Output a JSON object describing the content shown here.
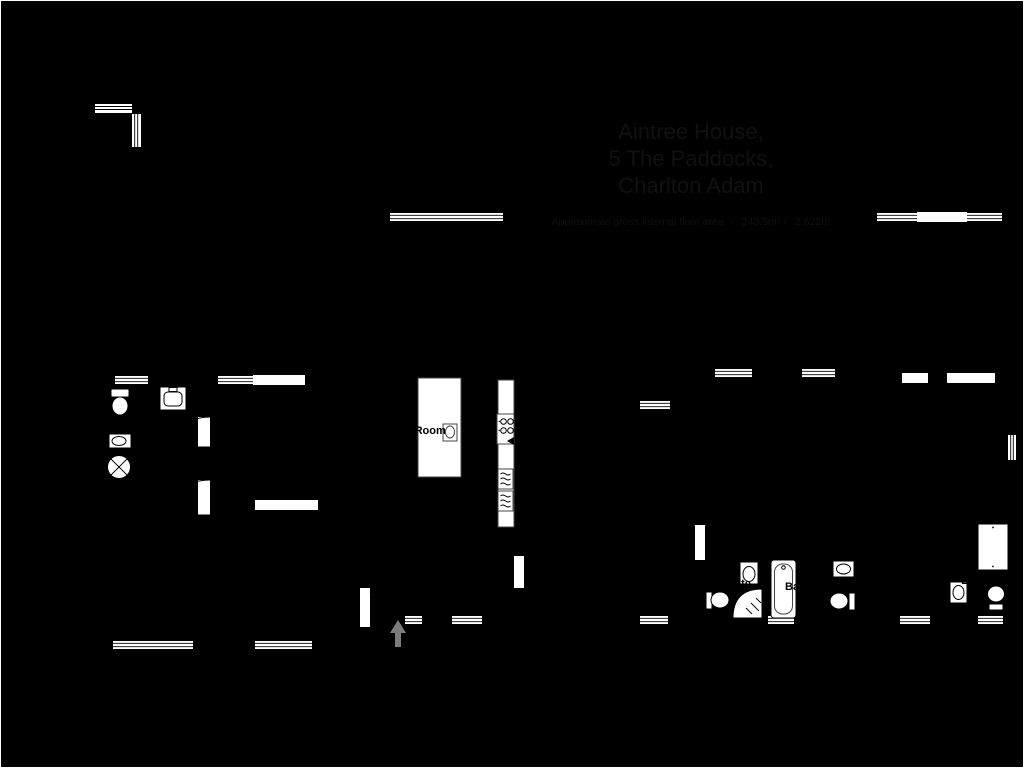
{
  "page": {
    "title_lines": [
      "Aintree House,",
      "5 The Paddocks,",
      "Charlton Adam"
    ],
    "subtitle": "Approximate gross internal floor area  -   243.5m² /   2,622ft²"
  },
  "compass": {
    "north": "N",
    "east": "E",
    "south": "S",
    "west": "W"
  },
  "studio": {
    "name": "Studio",
    "dims_m": "3.66 x 6.69m",
    "dims_ft": "12'0\" x 21'11\"",
    "area_label": "Area: 24.4 m² ... 263 ft²"
  },
  "ground_floor": {
    "floor_label": "Ground Floor",
    "area_label": "Area: 116.3 m² ... 1252 ft²",
    "kitchen": {
      "name": "Kitchen / Dining / Living Room",
      "dims_m": "9.30 x 9.40m",
      "dims_ft": "30'6\" x 30'10\""
    },
    "utility": {
      "name": "Utility"
    },
    "garage": {
      "name": "Garage",
      "dims_m": "3.00 x 5.97m",
      "dims_ft": "9'10\" x 19'7\""
    },
    "sitting_room": {
      "name": "Sitting Room",
      "dims_m": "4.43 x 4.30m",
      "dims_ft": "14'6\" x 14'1\""
    },
    "boot_room": {
      "name_line1": "Boot",
      "name_line2": "Room"
    }
  },
  "first_floor": {
    "floor_label": "First Floor",
    "area_label": "Area: 102.8 m² ... 1107 ft²",
    "bedroom_main": {
      "name": "Bedroom",
      "dims_m": "4.46 x 4.67m",
      "dims_ft": "14'8\" x 15'4\""
    },
    "bedroom_mid_left": {
      "name": "Bedroom",
      "dims_m": "2.65 x 3.85m",
      "dims_ft": "8'8\" x 12'7\""
    },
    "bedroom_mid_right": {
      "name": "Bedroom",
      "dims_m": "2.99 x 3.83m",
      "dims_ft": "9'10\" x 12'7\""
    },
    "bedroom_left": {
      "name": "Bedroom",
      "dims_m": "2.91 x 4.78m",
      "dims_ft": "9'6\" x 15'8\""
    },
    "ensuite_left": {
      "name": "Ensuite"
    },
    "bathroom": {
      "name": "Bathroom"
    },
    "ensuite_right": {
      "name": "Ensuite"
    }
  }
}
